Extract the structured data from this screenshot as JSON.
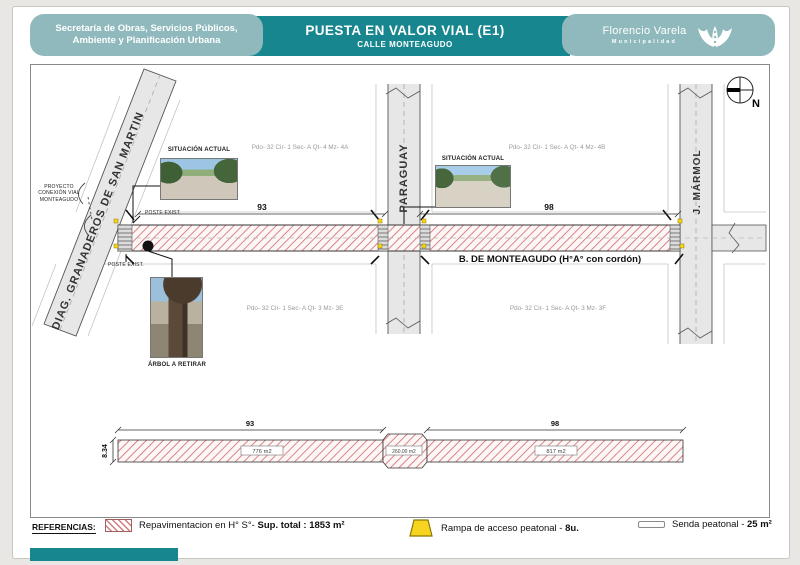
{
  "colors": {
    "teal_dark": "#17868f",
    "teal_light": "#8fb9bc",
    "hatch_red": "#d27c7c",
    "ramp_yellow": "#f6d41f"
  },
  "header": {
    "dept_line1": "Secretaría de Obras, Servicios Públicos,",
    "dept_line2": "Ambiente y Planificación Urbana",
    "title": "PUESTA EN VALOR VIAL (E1)",
    "subtitle": "CALLE MONTEAGUDO",
    "org": "Florencio Varela",
    "org_sub": "Municipalidad"
  },
  "compass": {
    "north": "N"
  },
  "plan": {
    "streets": {
      "diagonal": "DIAG. GRANADEROS DE SAN MARTIN",
      "paraguay": "PARAGUAY",
      "marmol": "J. MÁRMOL",
      "main_road": "B. DE MONTEAGUDO (H°A° con cordón)"
    },
    "dims": {
      "left": "93",
      "right": "98"
    },
    "parcels": [
      "Pdo- 32 Cir- 1 Sec- A Qt- 4 Mz- 4A",
      "Pdo- 32 Cir- 1 Sec- A Qt- 4 Mz- 4B",
      "Pdo- 32 Cir- 1 Sec- A Qt- 3 Mz- 3E",
      "Pdo- 32 Cir- 1 Sec- A Qt- 3 Mz- 3F"
    ],
    "annotations": {
      "proyecto_l1": "PROYECTO",
      "proyecto_l2": "CONEXIÓN VIAL",
      "proyecto_l3": "MONTEAGUDO",
      "poste": "POSTE EXIST.",
      "situacion": "SITUACIÓN ACTUAL",
      "arbol": "ÁRBOL A RETIRAR"
    }
  },
  "section": {
    "dim_left": "93",
    "dim_right": "98",
    "dim_height": "8.34",
    "area_left": "776 m2",
    "area_mid": "260.00 m2",
    "area_right": "817 m2"
  },
  "legend": {
    "title": "REFERENCIAS:",
    "repav_label": "Repavimentacion en H° S°- ",
    "repav_bold": "Sup. total : 1853 m²",
    "rampa_label": "Rampa de acceso peatonal - ",
    "rampa_bold": "8u.",
    "senda_label": "Senda peatonal - ",
    "senda_bold": "25 m²"
  }
}
